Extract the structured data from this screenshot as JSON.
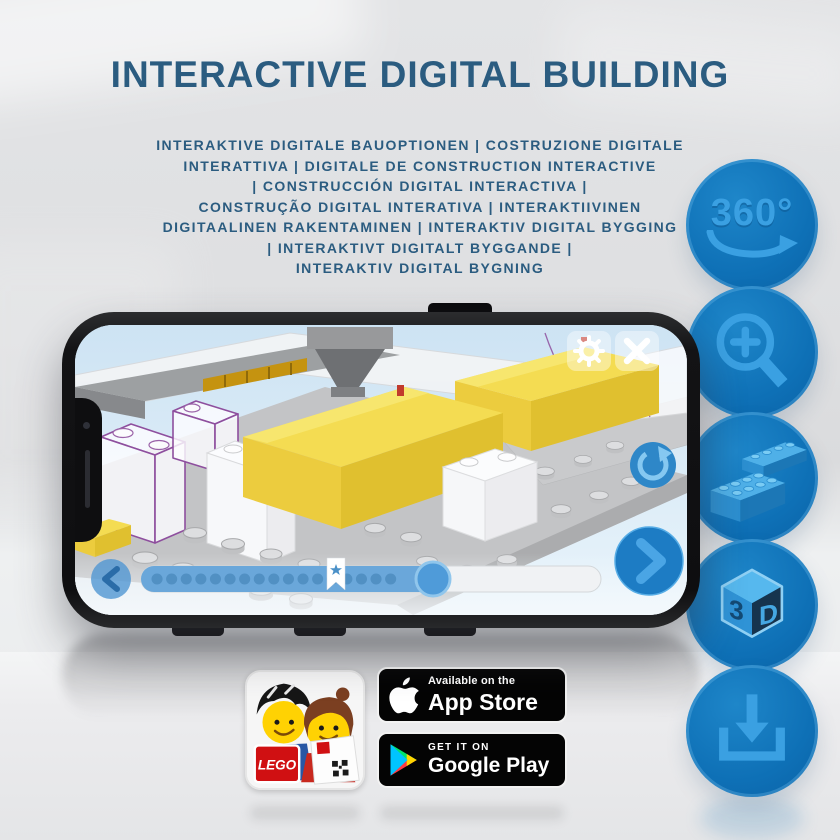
{
  "title": "INTERACTIVE DIGITAL BUILDING",
  "subtitle_lines": [
    "INTERAKTIVE DIGITALE BAUOPTIONEN | COSTRUZIONE DIGITALE",
    "INTERATTIVA | DIGITALE DE CONSTRUCTION INTERACTIVE",
    "| CONSTRUCCIÓN DIGITAL INTERACTIVA |",
    "CONSTRUÇÃO DIGITAL INTERATIVA | INTERAKTIIVINEN",
    "DIGITAALINEN RAKENTAMINEN | INTERAKTIV DIGITAL BYGGING",
    "| INTERAKTIVT DIGITALT BYGGANDE |",
    "INTERAKTIV DIGITAL BYGNING"
  ],
  "features": {
    "rotate360_label": "360°",
    "cube_num": "3",
    "cube_letter": "D",
    "icon_names": [
      "360-rotation",
      "zoom-in",
      "bricks",
      "3d-view",
      "download"
    ]
  },
  "badges": {
    "app_store_line1": "Available on the",
    "app_store_line2": "App Store",
    "google_play_line1": "GET IT ON",
    "google_play_line2": "Google Play",
    "lego_logo": "LEGO"
  },
  "colors": {
    "title_blue": "#2b5c80",
    "circle_blue": "#0e70b6",
    "icon_light_blue": "#3aa0e2",
    "lego_yellow": "#f3d94d",
    "screen_sky": "#d9eaf6",
    "ghost_outline_purple": "#8e4f9e"
  }
}
